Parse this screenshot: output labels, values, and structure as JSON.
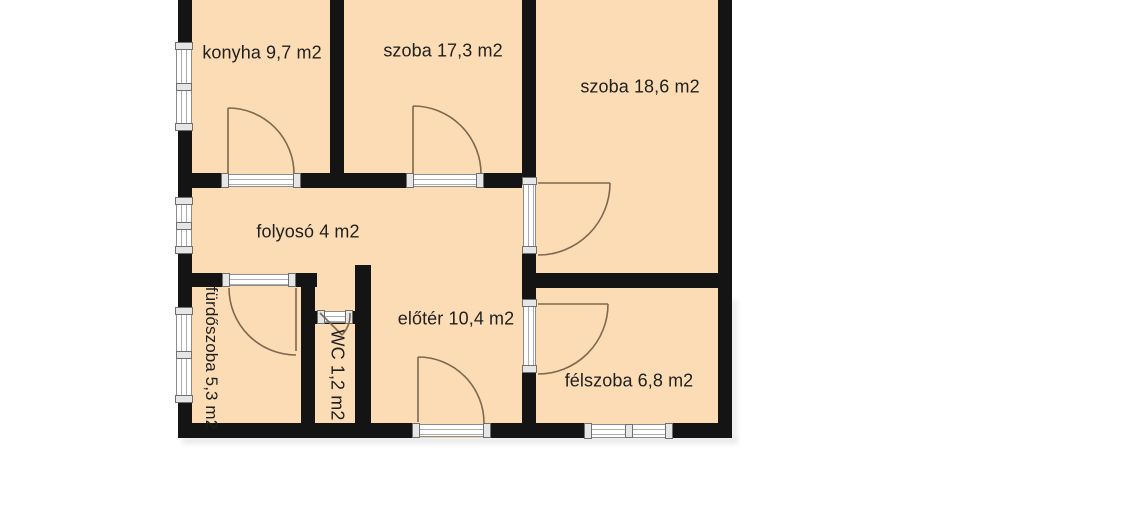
{
  "floor_plan": {
    "unit_suffix": "m2",
    "rooms": [
      {
        "id": "konyha",
        "label": "konyha 9,7 m2",
        "name": "konyha",
        "area": "9,7 m2",
        "cx": 262,
        "cy": 53,
        "rot": 0
      },
      {
        "id": "szoba-17",
        "label": "szoba 17,3 m2",
        "name": "szoba",
        "area": "17,3 m2",
        "cx": 443,
        "cy": 51,
        "rot": 0
      },
      {
        "id": "szoba-18",
        "label": "szoba 18,6 m2",
        "name": "szoba",
        "area": "18,6 m2",
        "cx": 640,
        "cy": 87,
        "rot": 0
      },
      {
        "id": "folyoso",
        "label": "folyosó 4 m2",
        "name": "folyosó",
        "area": "4 m2",
        "cx": 308,
        "cy": 232,
        "rot": 0
      },
      {
        "id": "eloter",
        "label": "előtér 10,4 m2",
        "name": "előtér",
        "area": "10,4 m2",
        "cx": 456,
        "cy": 319,
        "rot": 0
      },
      {
        "id": "felszoba",
        "label": "félszoba 6,8 m2",
        "name": "félszoba",
        "area": "6,8 m2",
        "cx": 629,
        "cy": 381,
        "rot": 0
      },
      {
        "id": "furdoszoba",
        "label": "fürdőszoba 5,3 m2",
        "name": "fürdőszoba",
        "area": "5,3 m2",
        "cx": 211,
        "cy": 358,
        "rot": 90
      },
      {
        "id": "wc",
        "label": "WC 1,2 m2",
        "name": "WC",
        "area": "1,2 m2",
        "cx": 337,
        "cy": 375,
        "rot": 90
      }
    ],
    "colors": {
      "background": "#ffffff",
      "room_fill": "#fbdcb5",
      "wall": "#141414",
      "door_swing": "#7d6950",
      "opening_frame": "#8c8c8c",
      "text": "#1f1f1f"
    },
    "geometry": {
      "plan_rect": {
        "x": 178,
        "y": 0,
        "w": 554,
        "h": 438
      },
      "walls": [
        [
          178,
          0,
          14,
          43
        ],
        [
          178,
          130,
          14,
          68
        ],
        [
          178,
          253,
          14,
          55
        ],
        [
          178,
          402,
          14,
          36
        ],
        [
          330,
          0,
          14,
          188
        ],
        [
          522,
          0,
          14,
          178
        ],
        [
          522,
          253,
          14,
          47
        ],
        [
          522,
          372,
          14,
          66
        ],
        [
          718,
          0,
          14,
          438
        ],
        [
          178,
          173,
          44,
          15
        ],
        [
          300,
          173,
          107,
          15
        ],
        [
          483,
          173,
          39,
          15
        ],
        [
          178,
          273,
          45,
          14
        ],
        [
          295,
          273,
          22,
          14
        ],
        [
          301,
          273,
          14,
          165
        ],
        [
          315,
          311,
          40,
          13
        ],
        [
          355,
          265,
          16,
          173
        ],
        [
          536,
          273,
          196,
          15
        ],
        [
          178,
          423,
          235,
          15
        ],
        [
          490,
          423,
          95,
          15
        ],
        [
          672,
          423,
          60,
          15
        ]
      ],
      "openings": [
        {
          "type": "window",
          "x": 176,
          "y": 43,
          "w": 16,
          "h": 87,
          "dir": "v"
        },
        {
          "type": "window",
          "x": 176,
          "y": 198,
          "w": 16,
          "h": 55,
          "dir": "v"
        },
        {
          "type": "window",
          "x": 176,
          "y": 308,
          "w": 16,
          "h": 94,
          "dir": "v"
        },
        {
          "type": "window",
          "x": 585,
          "y": 424,
          "w": 87,
          "h": 14,
          "dir": "h"
        },
        {
          "type": "door",
          "x": 222,
          "y": 174,
          "w": 78,
          "h": 13,
          "dir": "h"
        },
        {
          "type": "door",
          "x": 407,
          "y": 174,
          "w": 76,
          "h": 13,
          "dir": "h"
        },
        {
          "type": "door",
          "x": 223,
          "y": 274,
          "w": 72,
          "h": 12,
          "dir": "h"
        },
        {
          "type": "door",
          "x": 318,
          "y": 311,
          "w": 34,
          "h": 12,
          "dir": "h"
        },
        {
          "type": "door",
          "x": 523,
          "y": 178,
          "w": 13,
          "h": 75,
          "dir": "v"
        },
        {
          "type": "door",
          "x": 523,
          "y": 300,
          "w": 13,
          "h": 72,
          "dir": "v"
        },
        {
          "type": "door",
          "x": 413,
          "y": 424,
          "w": 77,
          "h": 13,
          "dir": "h"
        }
      ],
      "door_swings": [
        "M228,108 L228,174 M228,108 A66,66 0 0 1 294,174",
        "M413,106 L413,174 M413,106 A68,68 0 0 1 481,174",
        "M538,183 L610,183 M610,183 A72,72 0 0 1 538,255",
        "M538,304 L608,304 M608,304 A70,70 0 0 1 538,374",
        "M296,288 L296,351 M229,288 A67,67 0 0 0 296,355",
        "M418,357 L418,422 M418,357 A66,66 0 0 1 484,423",
        "M320,313 L342,335 M342,335 A30,30 0 0 0 350,313"
      ],
      "shadows": [
        [
          182,
          438,
          556,
          5
        ],
        [
          732,
          300,
          4,
          138
        ]
      ]
    }
  }
}
